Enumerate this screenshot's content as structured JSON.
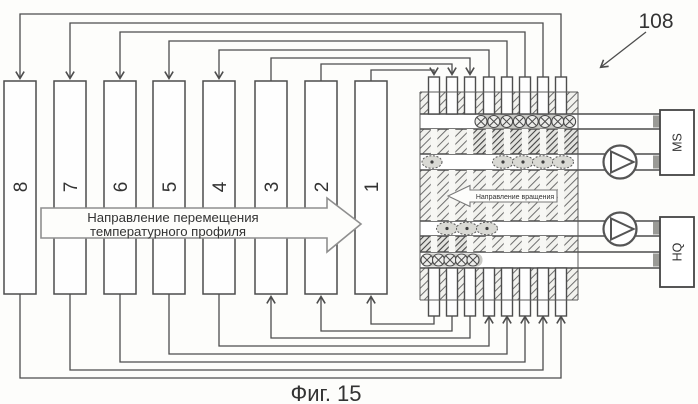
{
  "figure": {
    "device_label": "108",
    "caption": "Фиг. 15"
  },
  "bars": [
    {
      "label": "8"
    },
    {
      "label": "7"
    },
    {
      "label": "6"
    },
    {
      "label": "5"
    },
    {
      "label": "4"
    },
    {
      "label": "3"
    },
    {
      "label": "2"
    },
    {
      "label": "1"
    }
  ],
  "temperature_arrow": {
    "line1": "Направление перемещения",
    "line2": "температурного профиля"
  },
  "block": {
    "rotation_arrow_label": "Направление вращения"
  },
  "boxes": {
    "top": "MS",
    "bottom": "HQ"
  },
  "colors": {
    "line": "#4d4d4d",
    "hatch": "#6f6f6f",
    "hatch_dense": "#3f3f3f",
    "text": "#333333",
    "paper": "#fdfdfb"
  }
}
